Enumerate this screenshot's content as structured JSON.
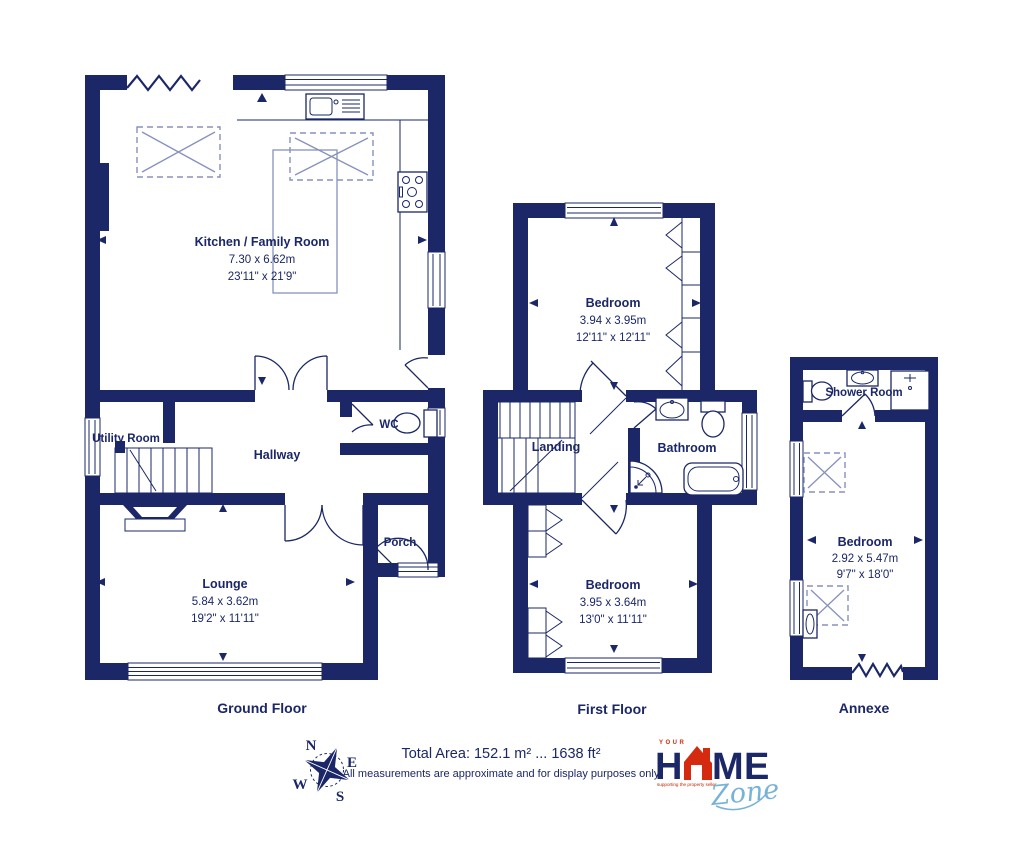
{
  "colors": {
    "wall": "#1b2767",
    "dash": "#8791bd",
    "logo_red": "#d42a10",
    "logo_orange": "#e96f15",
    "logo_yellow": "#f5b91c",
    "logo_blue": "#77b3d6",
    "tagline_red": "#cc2200"
  },
  "ground_floor": {
    "label": "Ground Floor",
    "rooms": {
      "kitchen": {
        "name": "Kitchen / Family Room",
        "metric": "7.30 x 6.62m",
        "imperial": "23'11\" x 21'9\""
      },
      "utility": {
        "name": "Utility Room"
      },
      "hallway": {
        "name": "Hallway"
      },
      "wc": {
        "name": "WC"
      },
      "lounge": {
        "name": "Lounge",
        "metric": "5.84 x 3.62m",
        "imperial": "19'2\" x 11'11\""
      },
      "porch": {
        "name": "Porch"
      }
    }
  },
  "first_floor": {
    "label": "First Floor",
    "rooms": {
      "bedroom_front": {
        "name": "Bedroom",
        "metric": "3.94 x 3.95m",
        "imperial": "12'11\" x 12'11\""
      },
      "landing": {
        "name": "Landing"
      },
      "bathroom": {
        "name": "Bathroom"
      },
      "bedroom_back": {
        "name": "Bedroom",
        "metric": "3.95 x 3.64m",
        "imperial": "13'0\" x 11'11\""
      }
    }
  },
  "annexe": {
    "label": "Annexe",
    "rooms": {
      "shower_room": {
        "name": "Shower Room"
      },
      "bedroom": {
        "name": "Bedroom",
        "metric": "2.92 x 5.47m",
        "imperial": "9'7\" x 18'0\""
      }
    }
  },
  "compass": {
    "north": "N",
    "east": "E",
    "south": "S",
    "west": "W"
  },
  "footer": {
    "total_area": "Total Area: 152.1 m² ... 1638 ft²",
    "disclaimer": "All measurements are approximate and for display purposes only"
  },
  "logo": {
    "your": "YOUR",
    "home_h": "H",
    "home_m": "M",
    "home_e": "E",
    "zone": "Zone",
    "tagline": "supporting the property seller"
  }
}
